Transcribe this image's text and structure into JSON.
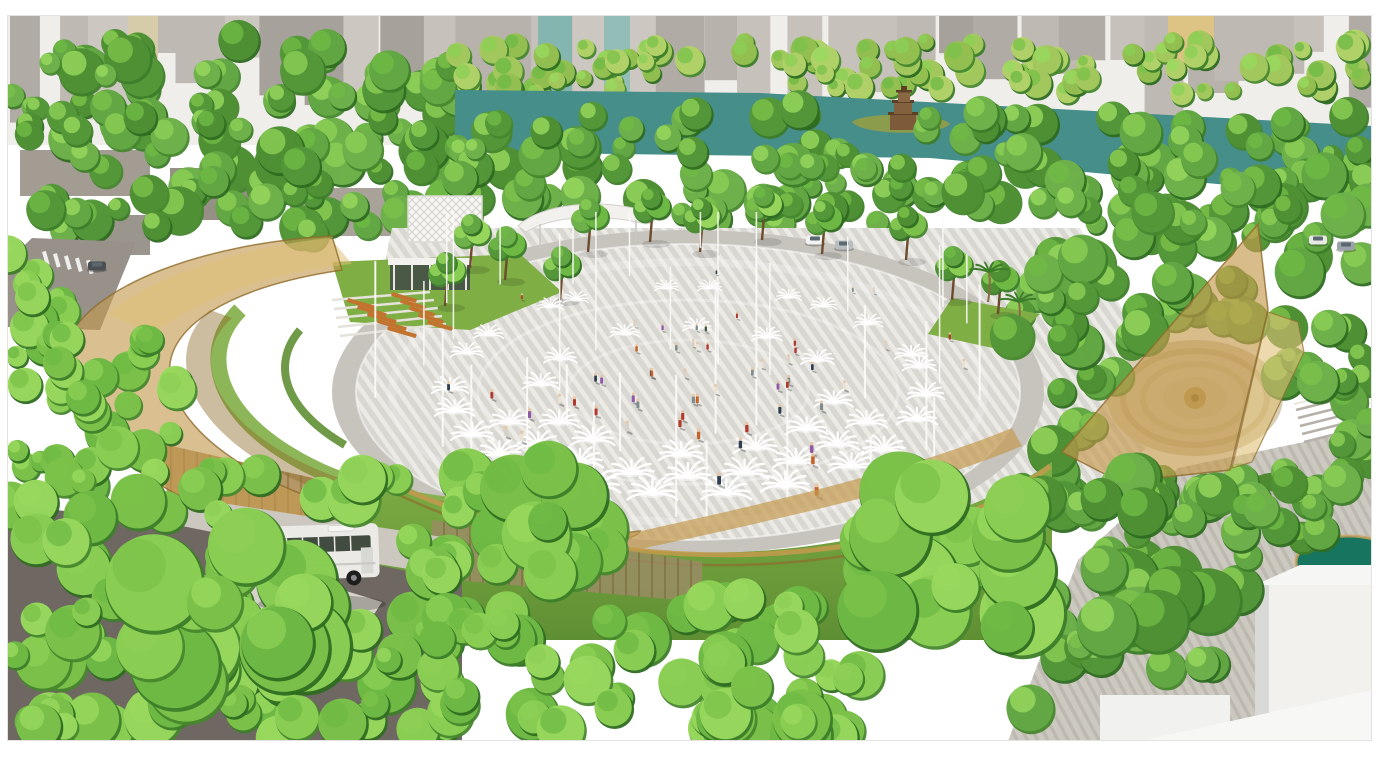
{
  "scene": {
    "type": "architectural-aerial-rendering",
    "seed": 20240521,
    "frame_inset": {
      "left": 7,
      "top": 15,
      "right": 18,
      "bottom": 16
    },
    "colors": {
      "frame": "#ffffff",
      "sky": "#edebe7",
      "haze": "#ffffff",
      "building_grays": [
        "#b3ada6",
        "#a39d96",
        "#bdb7b0",
        "#97918a",
        "#c4beb6",
        "#aba59e"
      ],
      "building_teal": "#6fa9a2",
      "building_teal2": "#7fb3ab",
      "building_yellow": "#d8ba70",
      "lake": "#468e8a",
      "island": "#8c9c4d",
      "tower_brown": "#7d5a39",
      "tower_dark": "#5d4127",
      "tree_dark": [
        "#2e6b21",
        "#3c7d29",
        "#47872e"
      ],
      "tree_mid": [
        "#55983a",
        "#63a844",
        "#6fb24b",
        "#4f9135"
      ],
      "tree_bright": [
        "#7cc24a",
        "#8ccf55",
        "#99d95e",
        "#6fba45"
      ],
      "tree_yellow": [
        "#a5c95f",
        "#b4d36a",
        "#96c153"
      ],
      "trunk": "#6d4c2e",
      "paving_base": "#d9d7d2",
      "paving_stripe": "#eceae5",
      "paving_ring": "#c7c4be",
      "deck_base": "#ccc9c1",
      "deck_stripe": "#bdb9b0",
      "gold": "#c49a4e",
      "gold_light": "#dfc077",
      "gold_dark": "#8e6c2d",
      "glass": "#a8854e",
      "lawn": "#7fae45",
      "lawn_dark": "#5f8f33",
      "road": "#6f6862",
      "road_light": "#97918a",
      "sidewalk": "#d7d3ca",
      "bench_orange": "#c2742e",
      "pond": "#17755f",
      "white_structure": "#f2f1ee",
      "cube_shade": "#d9d9d7",
      "pole_white": "#fbfbf9",
      "spray_white": "#ffffff",
      "bus_body": "#eceae6",
      "bus_window": "#414b40",
      "people": [
        "#b03a30",
        "#2f3f52",
        "#7f8c8d",
        "#c2652a",
        "#ece2d2",
        "#3d5a44",
        "#8e5aa8",
        "#d8d0c4"
      ]
    },
    "buildings": {
      "count": 34,
      "min_w": 26,
      "max_w": 64,
      "min_h": 34,
      "max_h": 112,
      "features": [
        {
          "x": 538,
          "w": 34,
          "h": 96,
          "color": "#6fa9a2"
        },
        {
          "x": 604,
          "w": 26,
          "h": 86,
          "color": "#7fb3ab"
        },
        {
          "x": 1168,
          "w": 46,
          "h": 54,
          "color": "#d8ba70"
        },
        {
          "x": 128,
          "w": 30,
          "h": 60,
          "color": "#cfc49c"
        }
      ]
    },
    "tree_bands": [
      {
        "name": "left-upper",
        "x": 7,
        "y": 40,
        "w": 455,
        "h": 195,
        "n": 120,
        "rmin": 10,
        "rmax": 24,
        "pal": "mid"
      },
      {
        "name": "far-shore",
        "x": 455,
        "y": 40,
        "w": 917,
        "h": 54,
        "n": 95,
        "rmin": 8,
        "rmax": 15,
        "pal": "yellow"
      },
      {
        "name": "near-shore",
        "x": 455,
        "y": 106,
        "w": 917,
        "h": 118,
        "n": 130,
        "rmin": 10,
        "rmax": 21,
        "pal": "mid"
      },
      {
        "name": "right-mass",
        "x": 1005,
        "y": 168,
        "w": 367,
        "h": 350,
        "n": 115,
        "rmin": 12,
        "rmax": 25,
        "pal": "mid"
      },
      {
        "name": "left-edge",
        "x": 7,
        "y": 250,
        "w": 70,
        "h": 240,
        "n": 20,
        "rmin": 10,
        "rmax": 20,
        "pal": "bright"
      },
      {
        "name": "left-lower",
        "x": 50,
        "y": 330,
        "w": 130,
        "h": 185,
        "n": 26,
        "rmin": 11,
        "rmax": 22,
        "pal": "bright"
      },
      {
        "name": "bottom-left",
        "x": 7,
        "y": 468,
        "w": 460,
        "h": 273,
        "n": 110,
        "rmin": 13,
        "rmax": 29,
        "pal": "bright"
      },
      {
        "name": "bottom-center",
        "x": 430,
        "y": 598,
        "w": 430,
        "h": 143,
        "n": 60,
        "rmin": 13,
        "rmax": 27,
        "pal": "bright"
      },
      {
        "name": "bottom-right",
        "x": 1020,
        "y": 470,
        "w": 330,
        "h": 271,
        "n": 62,
        "rmin": 12,
        "rmax": 25,
        "pal": "mid"
      }
    ],
    "fg_clusters": [
      {
        "cx": 545,
        "cy": 520,
        "r": 80,
        "n": 16,
        "pal": "bright"
      },
      {
        "cx": 950,
        "cy": 555,
        "r": 105,
        "n": 20,
        "pal": "bright"
      },
      {
        "cx": 1060,
        "cy": 300,
        "r": 60,
        "n": 10,
        "pal": "mid"
      },
      {
        "cx": 760,
        "cy": 700,
        "r": 70,
        "n": 12,
        "pal": "bright"
      },
      {
        "cx": 235,
        "cy": 618,
        "r": 110,
        "n": 18,
        "pal": "bright"
      },
      {
        "cx": 1160,
        "cy": 620,
        "r": 75,
        "n": 12,
        "pal": "mid"
      },
      {
        "cx": 1300,
        "cy": 500,
        "r": 55,
        "n": 9,
        "pal": "mid"
      }
    ],
    "row_trees": [
      [
        470,
        268
      ],
      [
        505,
        280
      ],
      [
        560,
        300
      ],
      [
        588,
        252
      ],
      [
        650,
        242
      ],
      [
        700,
        252
      ],
      [
        762,
        240
      ],
      [
        822,
        254
      ],
      [
        906,
        260
      ],
      [
        952,
        300
      ],
      [
        998,
        314
      ],
      [
        445,
        306
      ]
    ],
    "palms": [
      [
        988,
        302
      ],
      [
        1018,
        332
      ]
    ],
    "plaza": {
      "cx": 688,
      "cy": 392,
      "rx": 332,
      "ry": 148,
      "ring_rx": 356,
      "ring_ry": 162,
      "pole_count": 34,
      "pole_min_h": 55,
      "pole_max_h": 185,
      "pole_top_limit": 212,
      "fountain_rings": [
        {
          "n": 24,
          "rx": 238,
          "ry": 104,
          "bottom_only": false
        },
        {
          "n": 12,
          "rx": 148,
          "ry": 64,
          "bottom_only": false
        },
        {
          "n": 9,
          "rx": 192,
          "ry": 86,
          "bottom_only": true
        }
      ],
      "people_count": 60
    },
    "cars": [
      [
        815,
        240
      ],
      [
        844,
        245
      ],
      [
        1318,
        240
      ],
      [
        1346,
        246
      ],
      [
        97,
        266
      ]
    ],
    "geometry": {
      "lake": "M 455,90 L 760,93 L 1372,126 L 1372,198 L 930,158 L 455,152 Z",
      "lake_island": "M 852,122 C 862,112 940,112 950,124 C 940,136 864,136 852,122 Z",
      "plaza_apron": "M 392,228 L 1080,228 L 1180,420 L 1060,520 L 430,540 L 360,380 Z",
      "gold_left_outer": "M 332,236 C 205,243 92,285 68,340 C 48,392 95,455 192,502 C 284,546 424,562 562,549 C 606,545 637,539 640,531 C 556,541 468,540 388,521 C 268,493 178,438 170,376 C 164,328 228,287 342,270 Z",
      "gold_left_upper": "M 330,238 C 240,247 150,277 108,314 L 152,334 C 204,296 272,272 352,264 Z",
      "gold_left_inner": "M 210,310 C 170,345 178,405 250,455 C 320,503 430,525 540,518 L 536,504 C 430,508 330,487 264,440 C 206,398 196,350 232,318 Z",
      "gold_bottom_band": "M 600,540 C 760,505 905,472 1012,428 L 1022,446 C 912,492 764,522 608,556 Z",
      "gold_sail_main": "M 1062,452 L 1258,224 L 1268,310 L 1230,470 L 1120,482 Z",
      "gold_sail_second": "M 1232,468 L 1268,312 L 1298,322 L 1304,352 L 1252,462 Z",
      "glass_left": "M 163,444 L 432,505 L 432,576 L 204,540 C 172,520 158,482 163,444 Z",
      "glass_bottom": "M 432,520 L 702,562 L 702,602 L 432,578 Z",
      "lawn_top": "M 332,262 L 520,254 L 562,292 L 470,330 L 350,322 Z",
      "lawn_right1": "M 952,298 L 1040,314 L 1002,350 L 928,334 Z",
      "lawn_arc1": "M 240,310 C 200,350 215,410 290,455 C 350,492 440,510 520,508",
      "lawn_arc2": "M 300,330 C 270,365 285,410 345,445",
      "mound": "M 358,462 C 470,525 600,558 740,552 C 880,546 990,505 1052,462 L 1052,640 L 358,640 Z",
      "mound_gold1": "M 362,470 C 500,538 660,570 830,548 C 930,536 1005,502 1050,466",
      "mound_gold2": "M 380,486 C 510,550 660,580 830,558 C 925,546 1000,512 1046,478",
      "walkway_right": "M 1008,741 L 1078,560 L 1178,468 L 1372,428 L 1372,741 Z",
      "road_bl": "M 7,505 L 152,520 L 462,582 L 462,741 L 7,741 Z",
      "walk_strip_bl": "M 150,492 L 462,540 L 462,578 L 150,526 Z",
      "island_bl": "M 142,612 L 252,562 L 382,602 L 330,682 L 182,692 Z",
      "road_tl": "M 32,238 L 136,242 L 100,330 L 7,327 L 7,262 Z",
      "canopy_roof": "M 518,226 C 540,204 600,197 650,212 C 660,216 656,222 646,224 C 600,213 552,216 526,232 Z"
    }
  }
}
